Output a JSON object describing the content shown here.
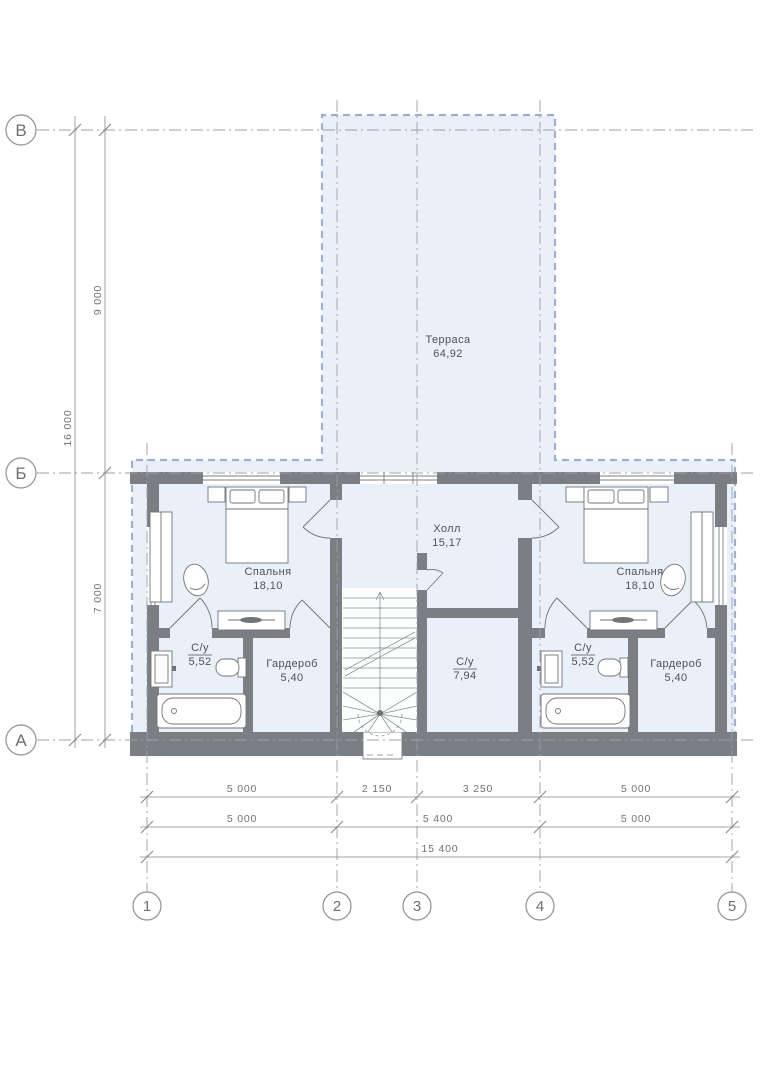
{
  "rooms": {
    "terrace": {
      "name": "Терраса",
      "area": "64,92"
    },
    "bedroom_left": {
      "name": "Спальня",
      "area": "18,10"
    },
    "bedroom_right": {
      "name": "Спальня",
      "area": "18,10"
    },
    "hall": {
      "name": "Холл",
      "area": "15,17"
    },
    "bath_left": {
      "name": "С/у",
      "area": "5,52"
    },
    "bath_right": {
      "name": "С/у",
      "area": "5,52"
    },
    "bath_center": {
      "name": "С/у",
      "area": "7,94"
    },
    "wardrobe_left": {
      "name": "Гардероб",
      "area": "5,40"
    },
    "wardrobe_right": {
      "name": "Гардероб",
      "area": "5,40"
    }
  },
  "grid": {
    "rows": [
      "В",
      "Б",
      "А"
    ],
    "cols": [
      "1",
      "2",
      "3",
      "4",
      "5"
    ]
  },
  "dims": {
    "left": {
      "upper": "9 000",
      "lower": "7 000",
      "total": "16 000"
    },
    "bottom": {
      "row1": [
        "5 000",
        "2 150",
        "3 250",
        "5 000"
      ],
      "row2": [
        "5 000",
        "5 400",
        "5 000"
      ],
      "total": "15 400"
    }
  },
  "colors": {
    "floor": "#eaf0f9",
    "wall": "#7b7f83",
    "terrace_border": "#a0aed0",
    "grid_line": "#9aa0a6",
    "dimension_line": "#85898d",
    "text": "#4d5257"
  }
}
